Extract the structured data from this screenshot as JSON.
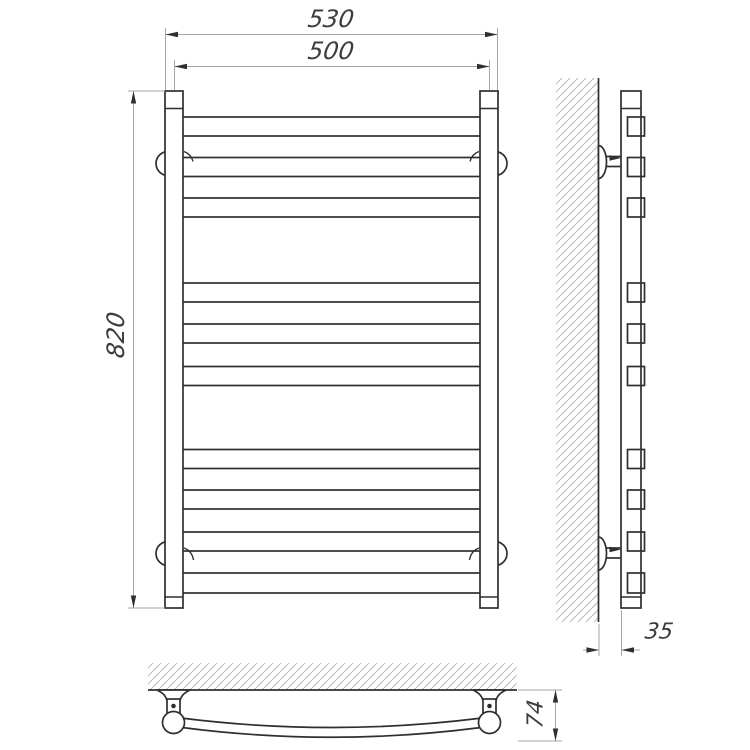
{
  "page": {
    "background_color": "#ffffff",
    "line_color": "#2f2f2f",
    "dimension_line_color": "#a6a6a6",
    "hatch_color": "#b8b8b8",
    "text_color": "#3d3d3d"
  },
  "drawing": {
    "type": "technical-drawing",
    "subject": "wall-mounted ladder towel rail shown in front, side and bottom orthographic views",
    "views": {
      "front_view": {
        "rung_count": 10,
        "rung_grouping": [
          3,
          3,
          4
        ],
        "vertical_rails": 2,
        "wall_bracket_circles": 4
      },
      "side_view": {
        "rung_end_caps": 10,
        "wall_brackets": 2,
        "has_wall_hatching": true
      },
      "bottom_view": {
        "shows": "curved rung bowing away from wall with two wall brackets",
        "wall_brackets": 2,
        "has_wall_hatching": true
      }
    },
    "dimensions": {
      "overall_width": "530",
      "rail_center_span": "500",
      "overall_height": "820",
      "wall_clearance": "35",
      "profile_depth": "74"
    }
  }
}
